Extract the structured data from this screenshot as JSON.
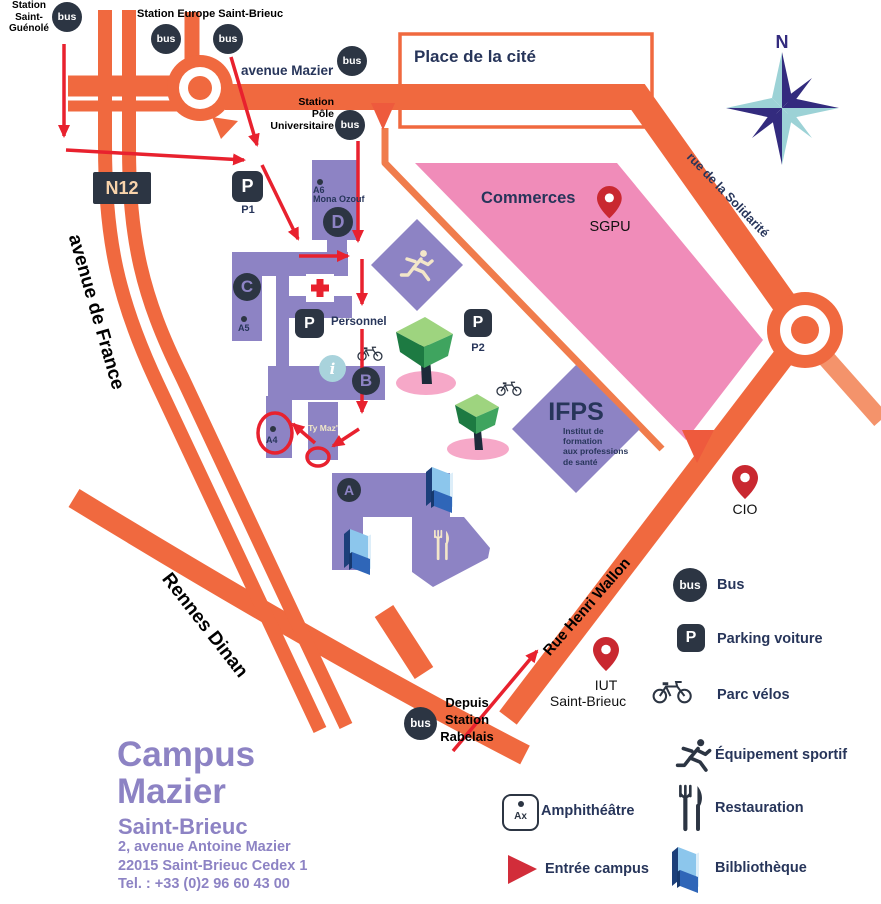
{
  "colors": {
    "road_orange": "#f0693f",
    "road_light_orange": "#f4936b",
    "building_purple": "#8d83c4",
    "icon_navy": "#2c3543",
    "text_navy": "#27355a",
    "commerces_pink": "#f08cb9",
    "tree_shadow_pink": "#f6a8c8",
    "route_red": "#e8212e",
    "pin_red": "#c92830",
    "info_teal": "#a9d3dc",
    "compass_navy": "#332b7e",
    "compass_teal": "#9cd2d6",
    "campus_purple": "#8d83c4"
  },
  "stations": {
    "saint_guenole": {
      "line1": "Station",
      "line2": "Saint-",
      "line3": "Guénolé"
    },
    "europe": "Station Europe Saint-Brieuc",
    "pole": {
      "line1": "Station",
      "line2": "Pôle",
      "line3": "Universitaire"
    },
    "rabelais": {
      "line1": "Depuis",
      "line2": "Station",
      "line3": "Rabelais"
    }
  },
  "roads": {
    "n12": "N12",
    "avenue_de_france": "avenue de France",
    "avenue_mazier": "avenue Mazier",
    "rennes_dinan": "Rennes Dinan",
    "rue_henri_wallon": "Rue Henri Wallon",
    "rue_solidarite": "rue de la Solidarité"
  },
  "places": {
    "place_cite": "Place de la cité",
    "commerces": "Commerces",
    "sgpu": "SGPU",
    "cio": "CIO",
    "iut_line1": "IUT",
    "iut_line2": "Saint-Brieuc",
    "ifps": "IFPS",
    "ifps_sub1": "Institut de",
    "ifps_sub2": "formation",
    "ifps_sub3": "aux professions",
    "ifps_sub4": "de santé"
  },
  "buildings": {
    "a": "A",
    "b": "B",
    "c": "C",
    "d": "D",
    "a4": "A4",
    "a5": "A5",
    "a6": "A6",
    "a6_name": "Mona Ozouf",
    "ty_maz": "Ty Maz'",
    "p1": "P1",
    "p2": "P2",
    "personnel": "Personnel",
    "p_letter": "P",
    "bus_text": "bus",
    "info_i": "i",
    "amphi_ax": "Ax"
  },
  "compass": {
    "north": "N"
  },
  "legend": {
    "items": [
      {
        "icon": "bus-icon",
        "label": "Bus"
      },
      {
        "icon": "parking-icon",
        "label": "Parking voiture"
      },
      {
        "icon": "bike-icon",
        "label": "Parc vélos"
      },
      {
        "icon": "sport-icon",
        "label": "Équipement sportif"
      },
      {
        "icon": "restaurant-icon",
        "label": "Restauration"
      },
      {
        "icon": "library-icon",
        "label": "Bilbliothèque"
      }
    ],
    "amphi": "Amphithéâtre",
    "entree": "Entrée campus"
  },
  "footer": {
    "title_line1": "Campus",
    "title_line2": "Mazier",
    "subtitle": "Saint-Brieuc",
    "address1": "2, avenue Antoine Mazier",
    "address2": "22015 Saint-Brieuc Cedex 1",
    "phone": "Tel. : +33 (0)2 96 60 43 00"
  }
}
